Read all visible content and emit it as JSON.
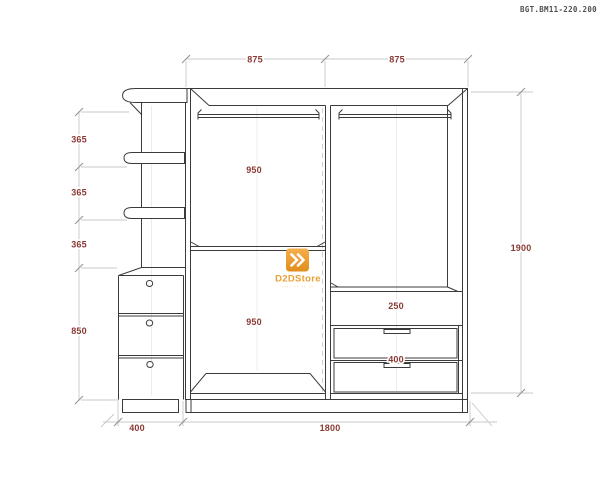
{
  "meta": {
    "doc_code": "BGT.BM11-220.200"
  },
  "watermark": {
    "brand": "D2DStore",
    "tagline": "···· ·· ·· ··"
  },
  "colors": {
    "accent_orange": "#F0A236",
    "dimension_text": "#8A3A33",
    "drawing_line": "#3B3B3B"
  },
  "dims": {
    "top_left_span": "875",
    "top_right_span": "875",
    "left_gaps": [
      "365",
      "365",
      "365"
    ],
    "left_drawer_unit_height": "850",
    "upper_section_height": "950",
    "lower_section_height": "950",
    "right_shelf_gap": "250",
    "right_drawer_section": "400",
    "overall_height": "1900",
    "side_unit_width": "400",
    "wardrobe_width": "1800"
  }
}
